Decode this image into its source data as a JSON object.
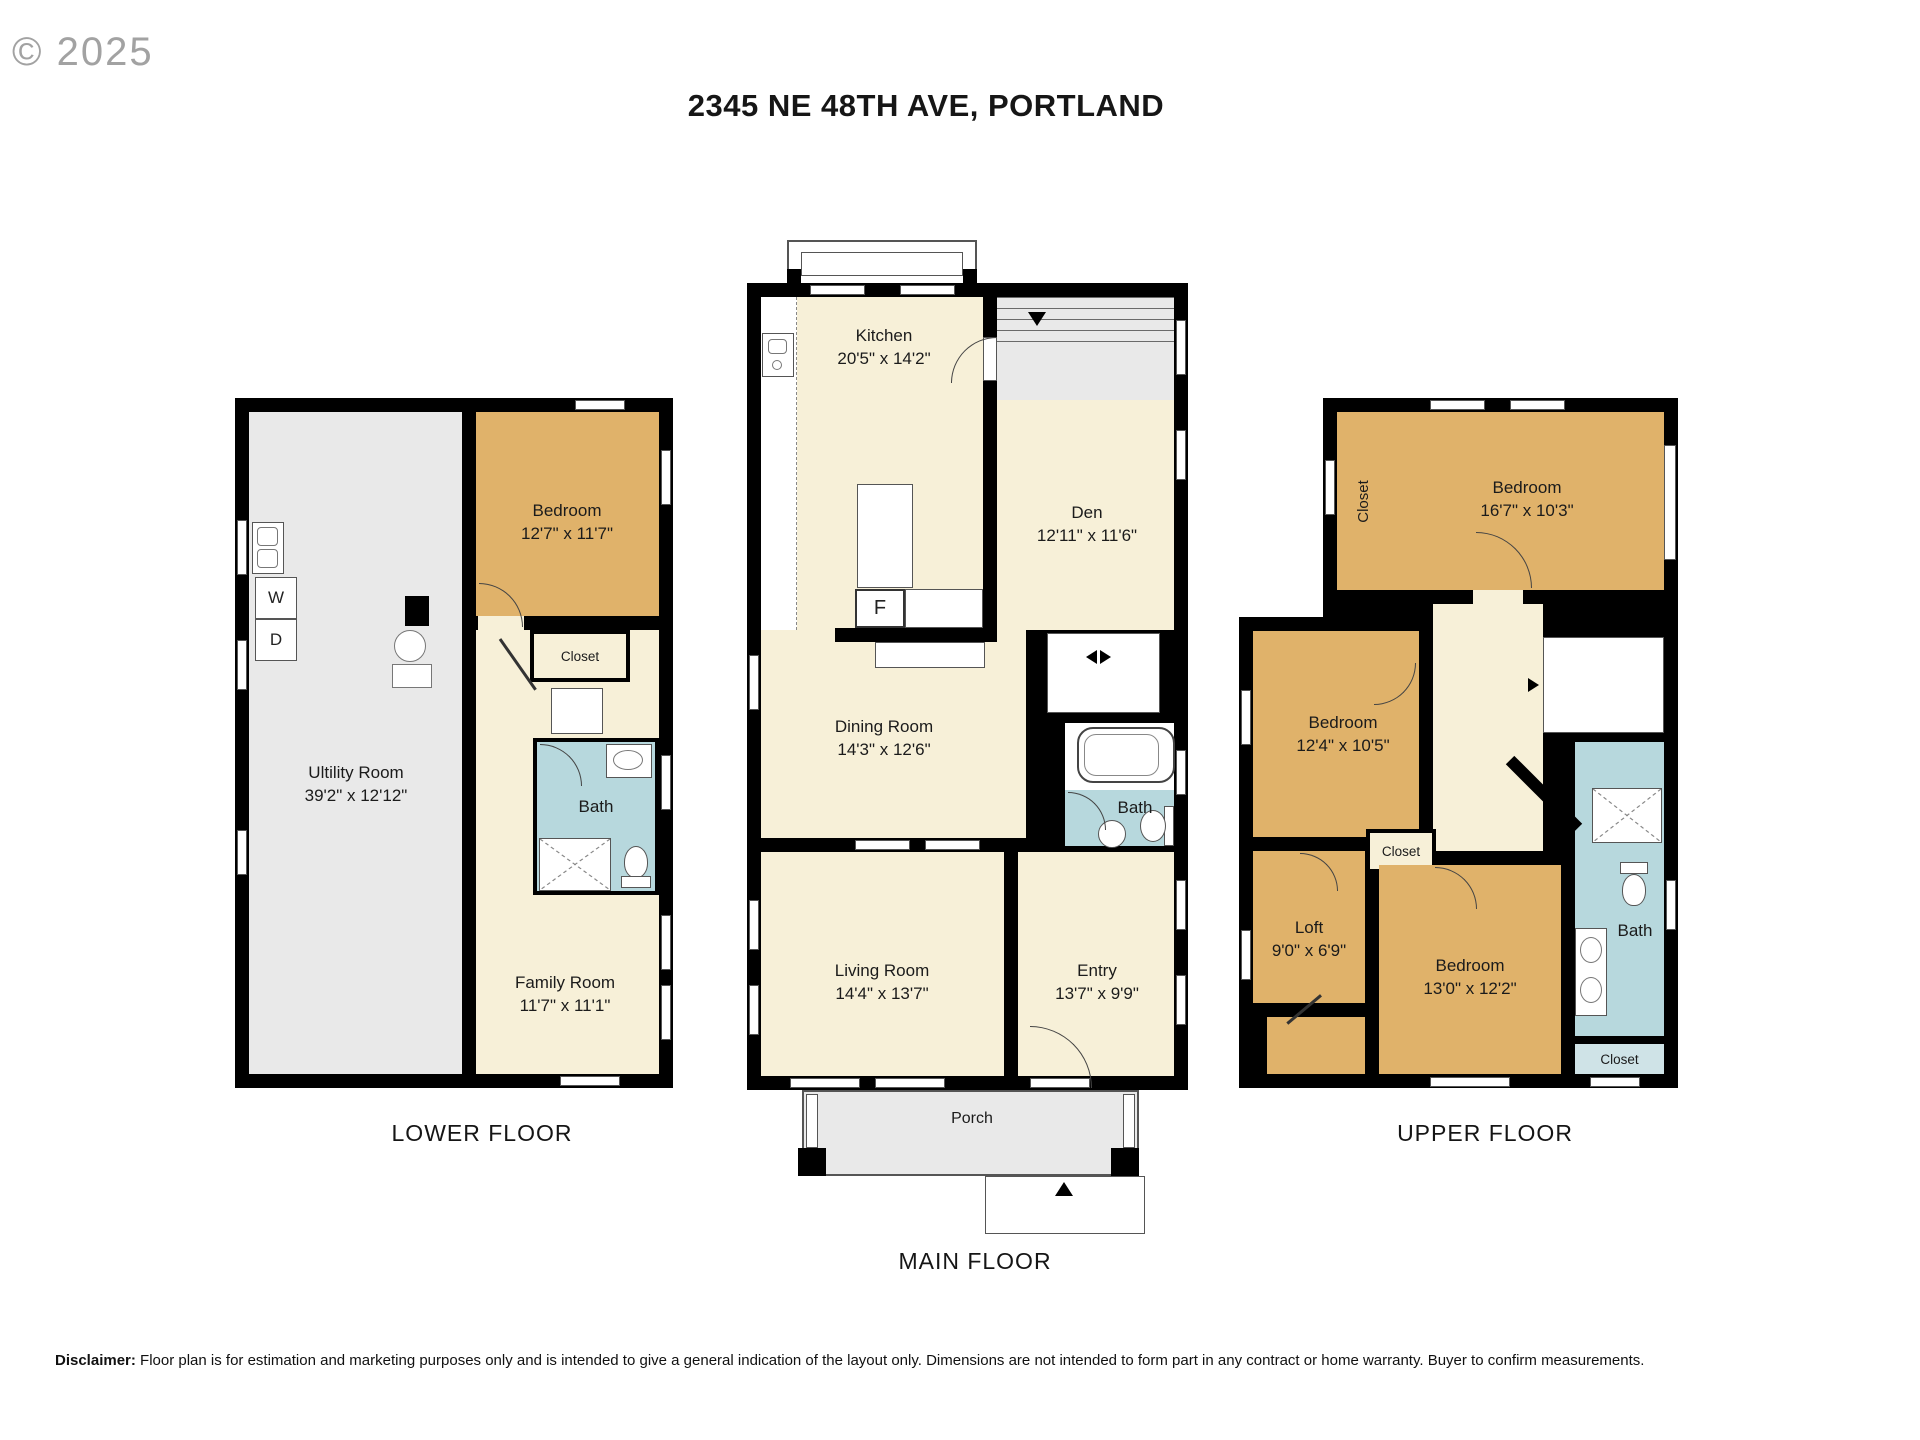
{
  "meta": {
    "copyright": "© 2025",
    "title": "2345 NE 48TH AVE, PORTLAND"
  },
  "disclaimer": {
    "label": "Disclaimer:",
    "text": " Floor plan is for estimation and marketing purposes only and is intended to give a general indication of the layout only. Dimensions are not intended to form part in any contract or home warranty. Buyer to confirm measurements."
  },
  "colors": {
    "wall": "#000000",
    "bedroom_tan": "#e0b26a",
    "living_cream": "#f7f0d8",
    "utility_gray": "#e9e9e9",
    "bath_teal": "#b7d8dd",
    "closet_light_teal": "#cfe3e7"
  },
  "floors": {
    "lower": {
      "label": "LOWER FLOOR",
      "rooms": {
        "utility": {
          "name": "Ultility Room",
          "dims": "39'2\" x 12'12\""
        },
        "bedroom": {
          "name": "Bedroom",
          "dims": "12'7\" x 11'7\""
        },
        "closet": {
          "name": "Closet"
        },
        "bath": {
          "name": "Bath"
        },
        "family": {
          "name": "Family Room",
          "dims": "11'7\" x 11'1\""
        }
      },
      "appliances": {
        "washer": "W",
        "dryer": "D"
      }
    },
    "main": {
      "label": "MAIN FLOOR",
      "rooms": {
        "kitchen": {
          "name": "Kitchen",
          "dims": "20'5\" x 14'2\""
        },
        "den": {
          "name": "Den",
          "dims": "12'11\" x 11'6\""
        },
        "dining": {
          "name": "Dining Room",
          "dims": "14'3\" x 12'6\""
        },
        "bath": {
          "name": "Bath"
        },
        "living": {
          "name": "Living Room",
          "dims": "14'4\" x 13'7\""
        },
        "entry": {
          "name": "Entry",
          "dims": "13'7\" x 9'9\""
        },
        "porch": {
          "name": "Porch"
        }
      },
      "appliances": {
        "fridge": "F"
      }
    },
    "upper": {
      "label": "UPPER FLOOR",
      "rooms": {
        "closet_top": {
          "name": "Closet"
        },
        "bedroom_top": {
          "name": "Bedroom",
          "dims": "16'7\" x 10'3\""
        },
        "bedroom_mid": {
          "name": "Bedroom",
          "dims": "12'4\" x 10'5\""
        },
        "closet_mid": {
          "name": "Closet"
        },
        "loft": {
          "name": "Loft",
          "dims": "9'0\" x 6'9\""
        },
        "bedroom_bottom": {
          "name": "Bedroom",
          "dims": "13'0\" x 12'2\""
        },
        "bath": {
          "name": "Bath"
        },
        "closet_loft": {
          "name": "Closet"
        },
        "closet_bath": {
          "name": "Closet"
        }
      }
    }
  }
}
